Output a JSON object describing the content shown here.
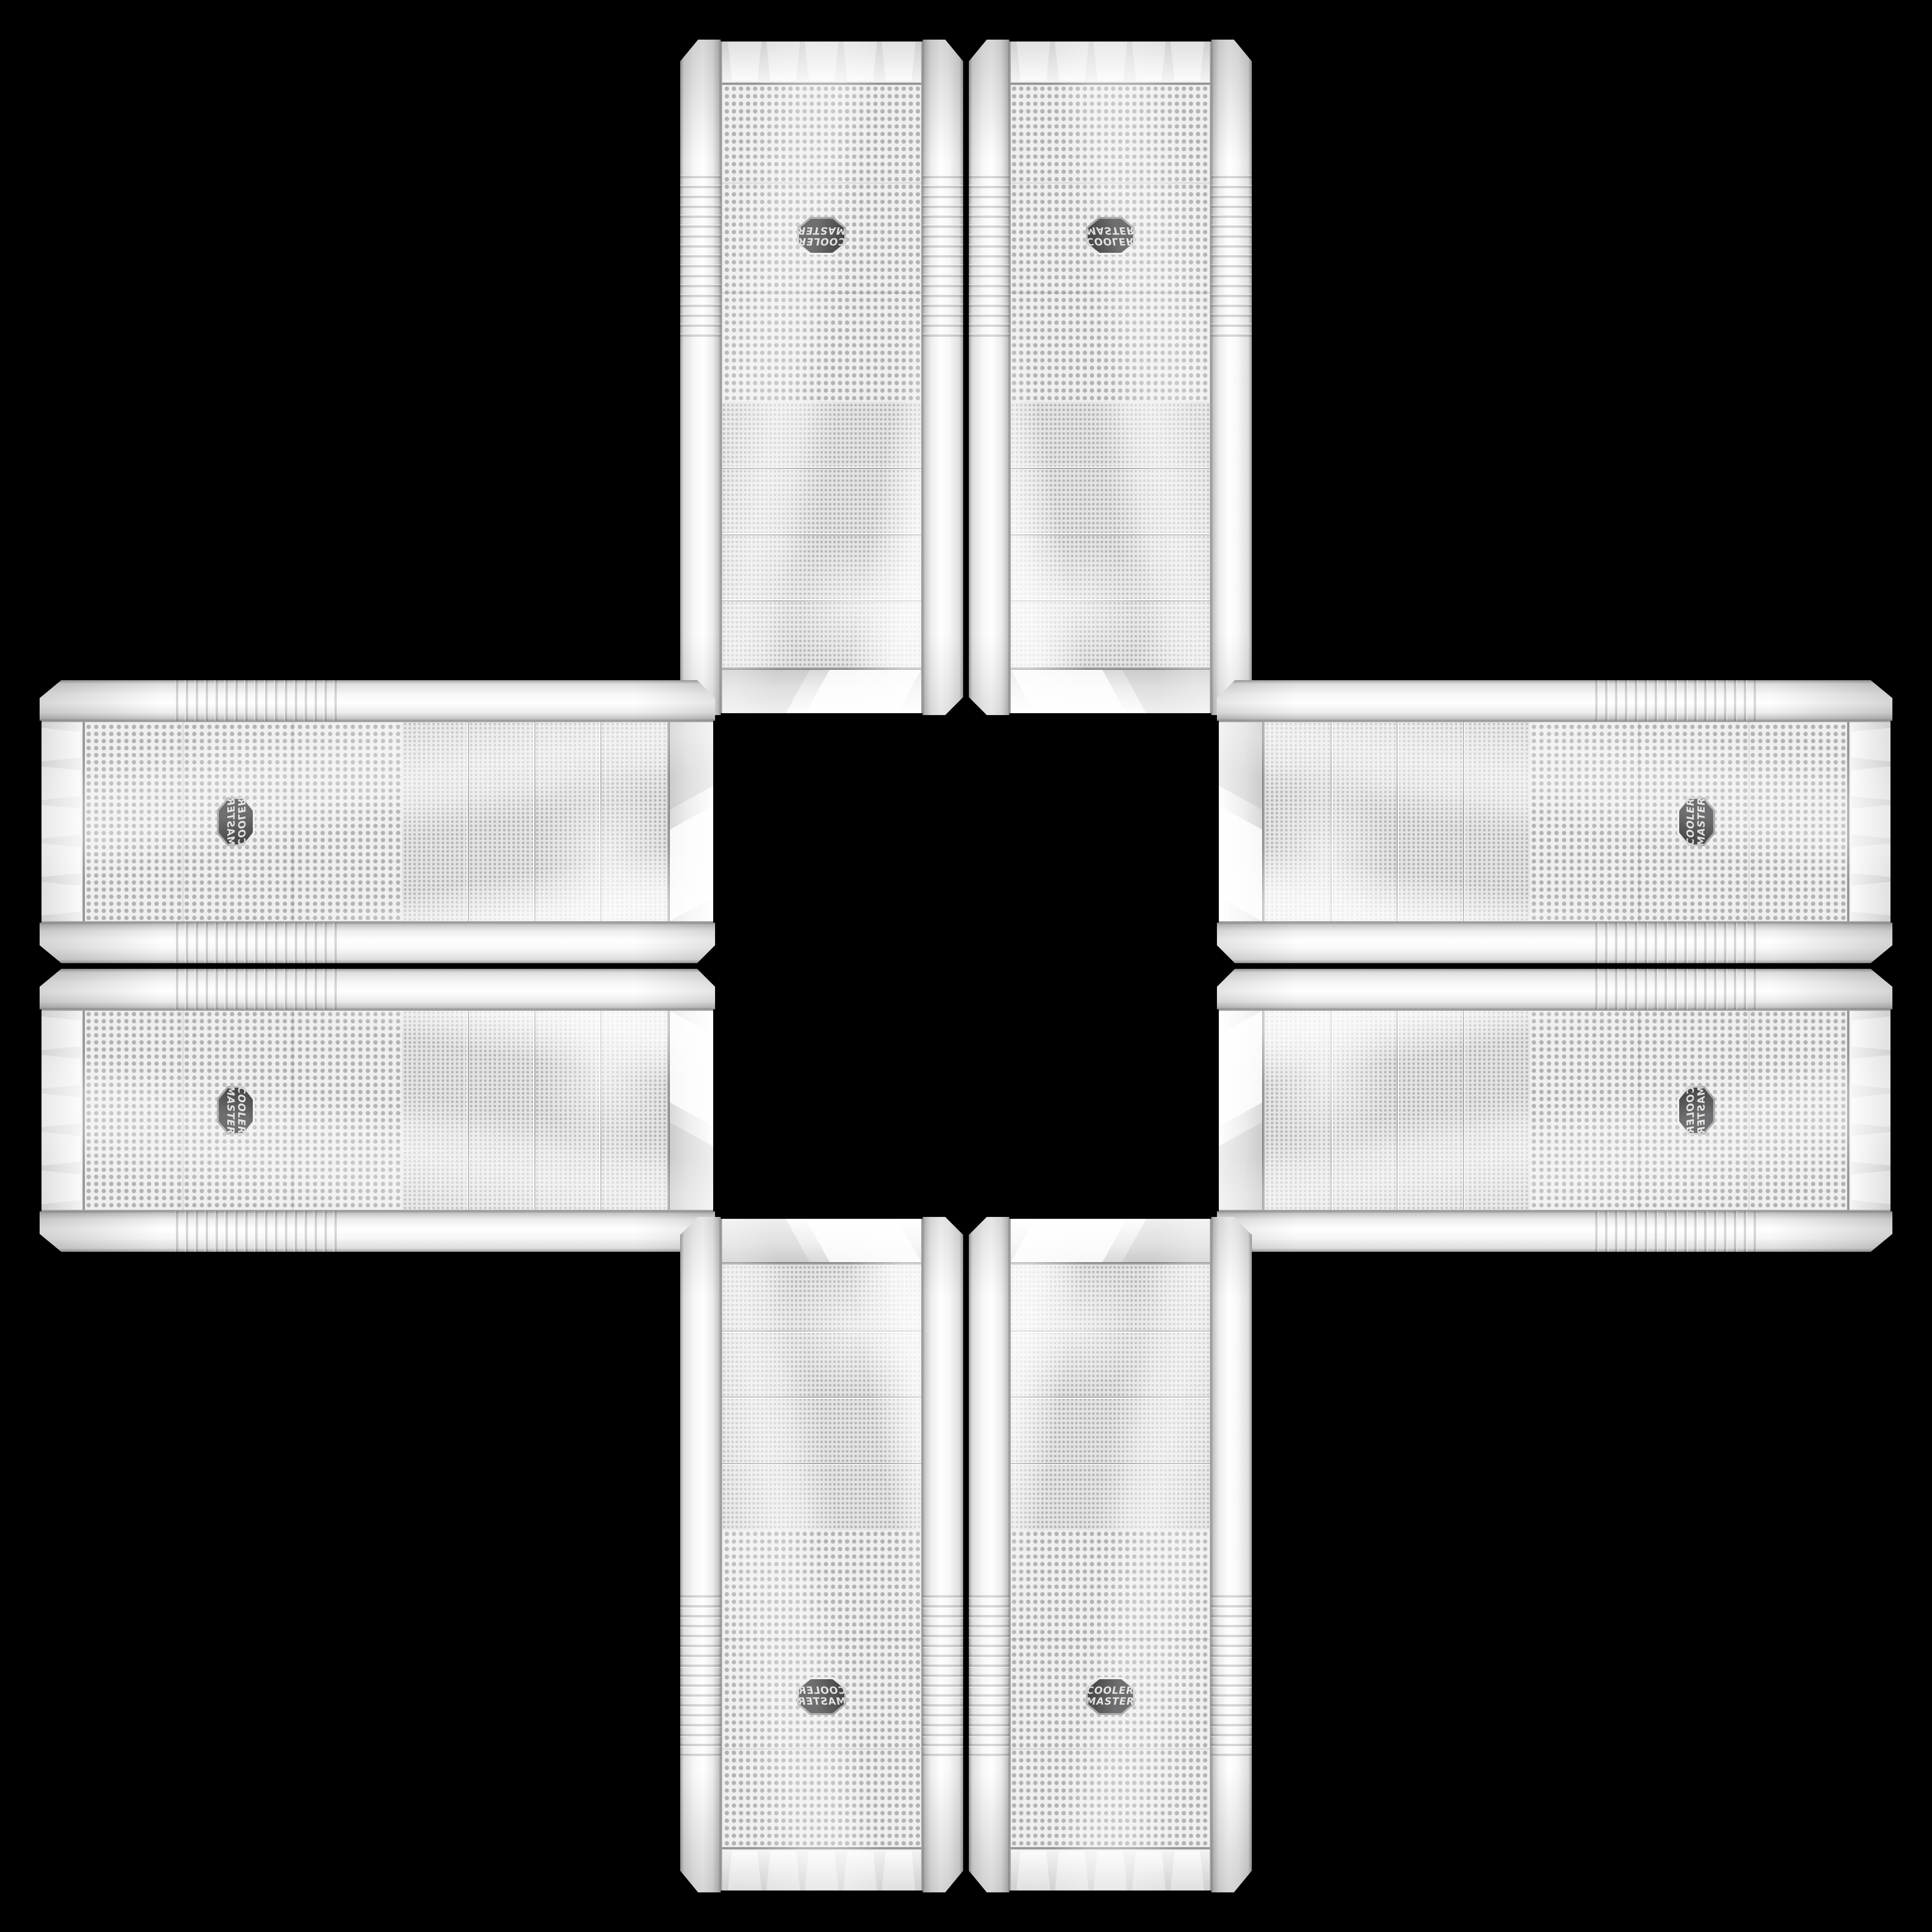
{
  "scene": {
    "description": "Eight identical white Cooler Master mesh-front mid-tower PC cases arranged in a plus / cross pattern on a black background; drive-bay ends all face the canvas center",
    "background": "black"
  },
  "brand": {
    "line1": "COOLER",
    "line2": "MASTER"
  },
  "colors": {
    "bg": "#000000",
    "case-white": "#f4f4f4",
    "mesh-base": "#ececec",
    "mesh-dot": "#b5b5b5",
    "trim-silver": "#a2a2a2",
    "badge-bg": "#38383a",
    "badge-text": "#dcdcdc"
  },
  "cases": [
    {
      "id": "top-left",
      "orientation": "rotated-180"
    },
    {
      "id": "top-right",
      "orientation": "rotated-180-mirrored"
    },
    {
      "id": "left-top",
      "orientation": "rotated-90cw-mirrored"
    },
    {
      "id": "left-bottom",
      "orientation": "rotated-90cw"
    },
    {
      "id": "right-top",
      "orientation": "rotated-90ccw"
    },
    {
      "id": "right-bottom",
      "orientation": "rotated-90ccw-mirrored"
    },
    {
      "id": "bottom-left",
      "orientation": "upright-mirrored"
    },
    {
      "id": "bottom-right",
      "orientation": "upright"
    }
  ]
}
